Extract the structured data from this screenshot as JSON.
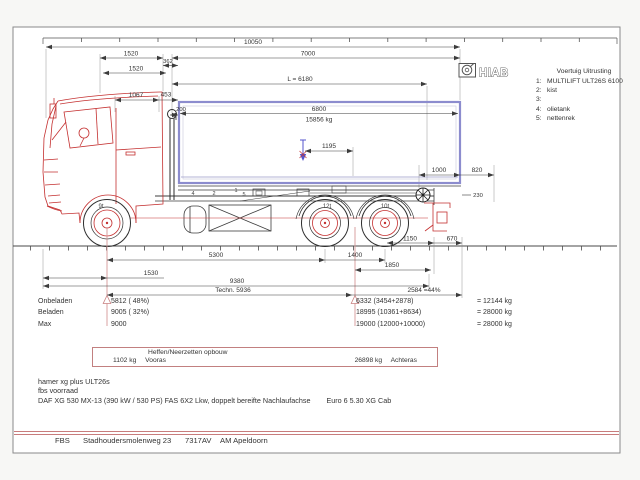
{
  "logo": {
    "name": "HIAB"
  },
  "equipment": {
    "title": "Voertuig Uitrusting",
    "items": [
      {
        "n": "1:",
        "label": "MULTILIFT  ULT26S 6100"
      },
      {
        "n": "2:",
        "label": "kist"
      },
      {
        "n": "3:",
        "label": ""
      },
      {
        "n": "4:",
        "label": "olietank"
      },
      {
        "n": "5:",
        "label": "nettenrek"
      }
    ]
  },
  "dims": {
    "total_length": "10050",
    "d1520_a": "1520",
    "d7000": "7000",
    "d362": "362",
    "d1520_b": "1520",
    "container_length": "L = 6180",
    "d1067": "1067",
    "d453": "453",
    "d200": "200",
    "inner_length": "6800",
    "payload": "15856 kg",
    "d1195": "1195",
    "d1000": "1000",
    "d820": "820",
    "d230": "230",
    "d1150": "1150",
    "d670": "670",
    "wheelbase": "5300",
    "axle_spread": "1400",
    "front_overhang": "1530",
    "d1850": "1850",
    "d9380": "9380",
    "techn_length": "Techn. 5936",
    "rear_pct": "2584 =44%"
  },
  "axles": {
    "front": "9t",
    "drive": "12t",
    "tag": "10t"
  },
  "chassis_items": {
    "i4": "4",
    "i2": "2",
    "i1": "1",
    "i5": "5"
  },
  "weights": {
    "rows": [
      {
        "label": "Onbeladen",
        "front": "5812 ( 48%)",
        "rear": "6332 (3454+2878)",
        "total": "= 12144 kg"
      },
      {
        "label": "Beladen",
        "front": "9005 ( 32%)",
        "rear": "18995 (10361+8634)",
        "total": "= 28000 kg"
      },
      {
        "label": "Max",
        "front": "9000",
        "rear": "19000 (12000+10000)",
        "total": "= 28000 kg"
      }
    ]
  },
  "lift_box": {
    "title": "Heffen/Neerzetten opbouw",
    "front_value": "1102 kg",
    "front_label": "Vooras",
    "rear_value": "26898 kg",
    "rear_label": "Achteras"
  },
  "notes": {
    "line1": "hamer xg plus ULT26s",
    "line2": "fbs voorraad",
    "line3a": "DAF XG 530 MX-13 (390 kW / 530 PS) FAS 6X2 Lkw, doppelt bereifte Nachlaufachse",
    "line3b": "Euro 6 5.30 XG Cab"
  },
  "footer": {
    "company": "FBS",
    "address": "Stadhoudersmolenweg 23",
    "postcode": "7317AV",
    "city": "AM Apeldoorn"
  },
  "colors": {
    "cab_red": "#c43030",
    "container_blue": "#8c8cce",
    "axle_marker_pink": "#d49898",
    "accent_red_line": "#c87c7c",
    "pin_blue": "#5555cc"
  }
}
